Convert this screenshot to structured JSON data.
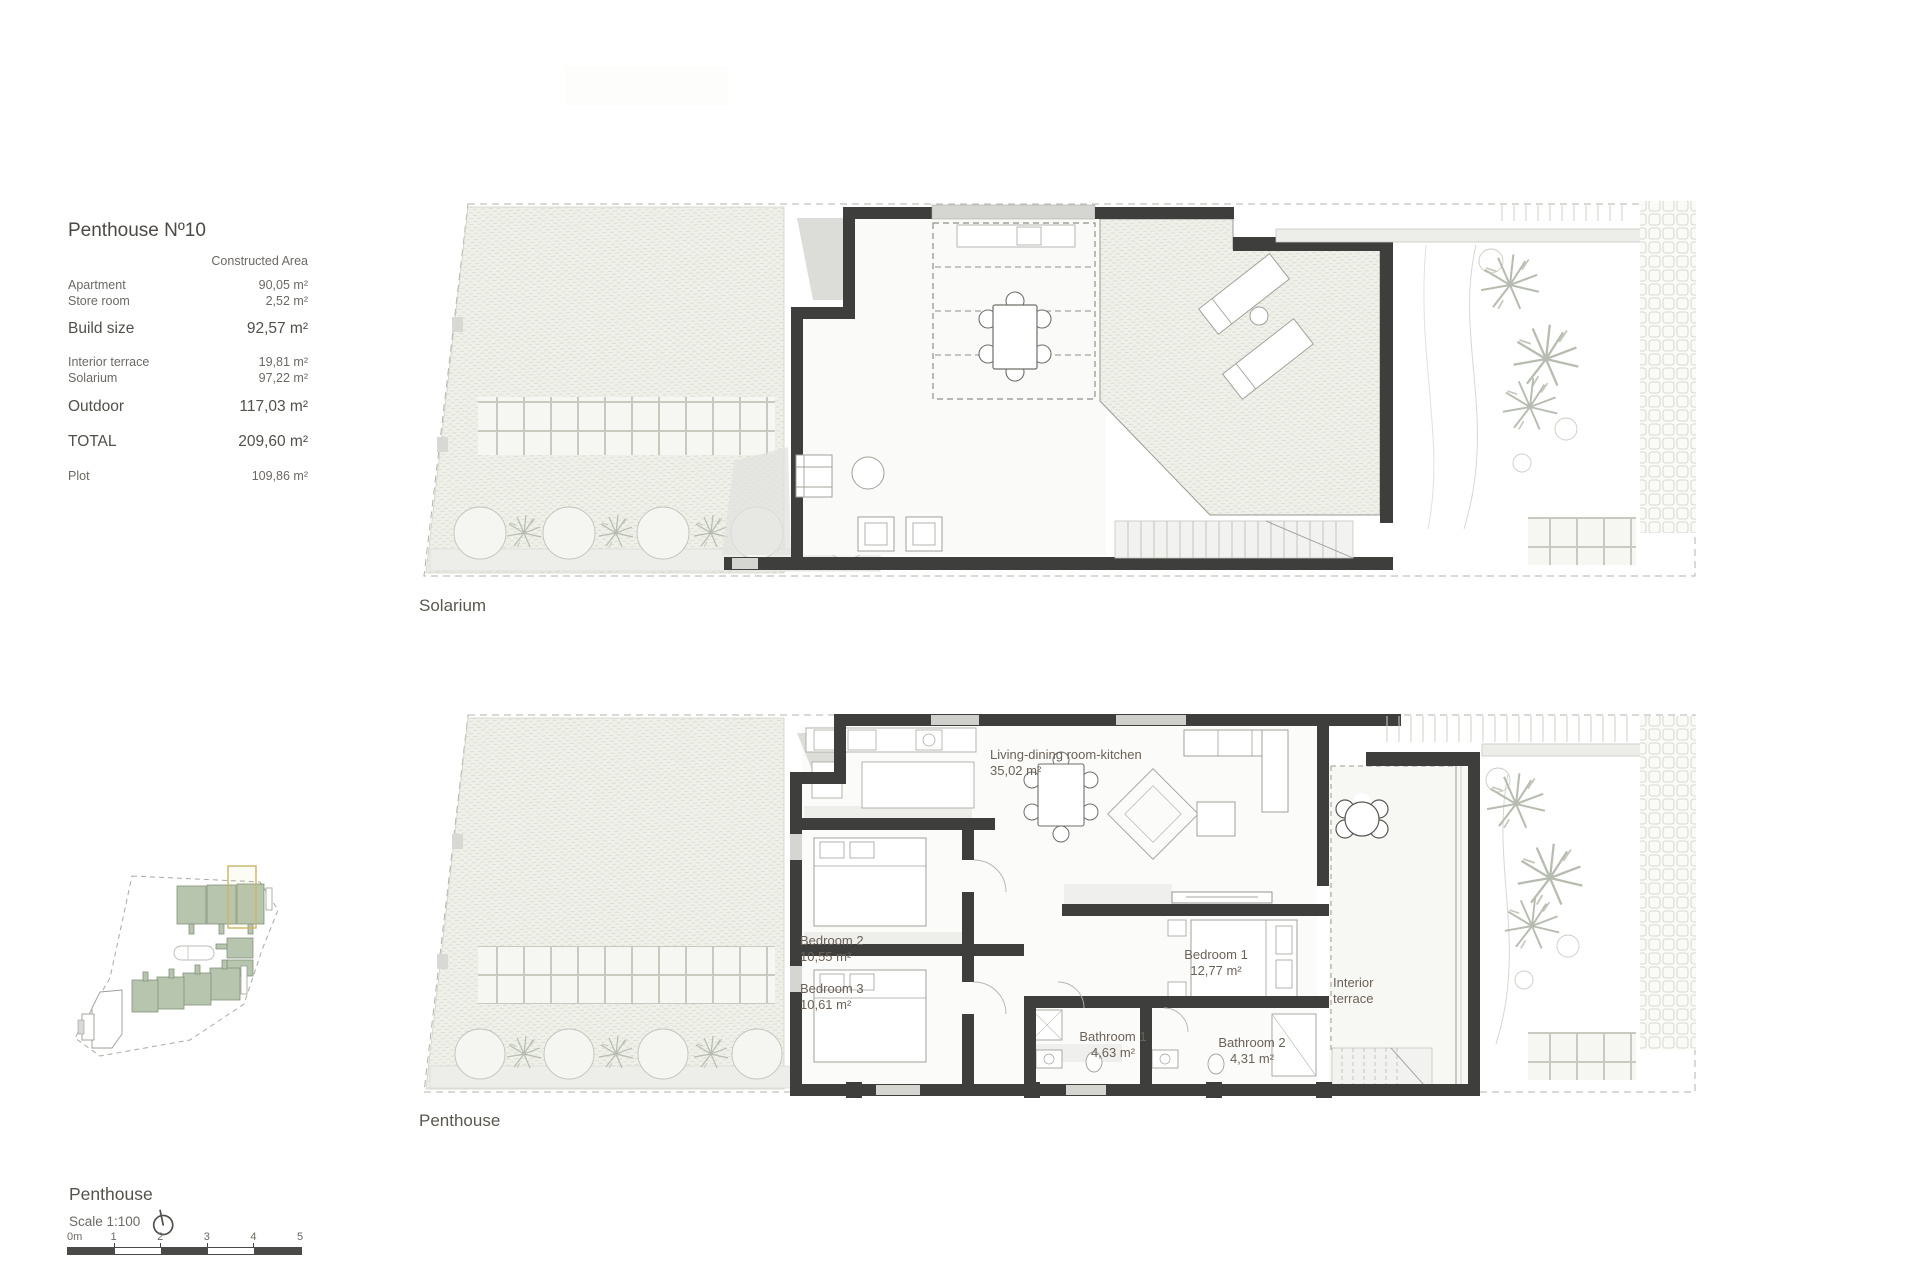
{
  "info_panel": {
    "title": "Penthouse Nº10",
    "column_header": "Constructed Area",
    "constructed_rows": [
      {
        "label": "Apartment",
        "value": "90,05 m²"
      },
      {
        "label": "Store room",
        "value": "2,52 m²"
      }
    ],
    "build_size": {
      "label": "Build size",
      "value": "92,57 m²"
    },
    "outdoor_rows": [
      {
        "label": "Interior terrace",
        "value": "19,81 m²"
      },
      {
        "label": "Solarium",
        "value": "97,22 m²"
      }
    ],
    "outdoor": {
      "label": "Outdoor",
      "value": "117,03 m²"
    },
    "total": {
      "label": "TOTAL",
      "value": "209,60 m²"
    },
    "plot": {
      "label": "Plot",
      "value": "109,86 m²"
    }
  },
  "solarium_plan": {
    "caption": "Solarium"
  },
  "penthouse_plan": {
    "caption": "Penthouse",
    "rooms": [
      {
        "name": "Living-dining room-kitchen",
        "area": "35,02 m²"
      },
      {
        "name": "Bedroom 2",
        "area": "10,55 m²"
      },
      {
        "name": "Bedroom 3",
        "area": "10,61 m²"
      },
      {
        "name": "Bedroom 1",
        "area": "12,77 m²"
      },
      {
        "name": "Bathroom 1",
        "area": "4,63 m²"
      },
      {
        "name": "Bathroom 2",
        "area": "4,31 m²"
      },
      {
        "name": "Interior terrace",
        "area": ""
      }
    ]
  },
  "footer": {
    "title": "Penthouse",
    "scale": "Scale 1:100",
    "scale_bar_labels": [
      "0m",
      "1",
      "2",
      "3",
      "4",
      "5"
    ]
  },
  "colors": {
    "wall": "#3e3e3c",
    "hatch_fill": "#eef0e9",
    "site_building": "#b7c4ae",
    "highlight": "#c8b667",
    "text": "#5d5a54"
  }
}
